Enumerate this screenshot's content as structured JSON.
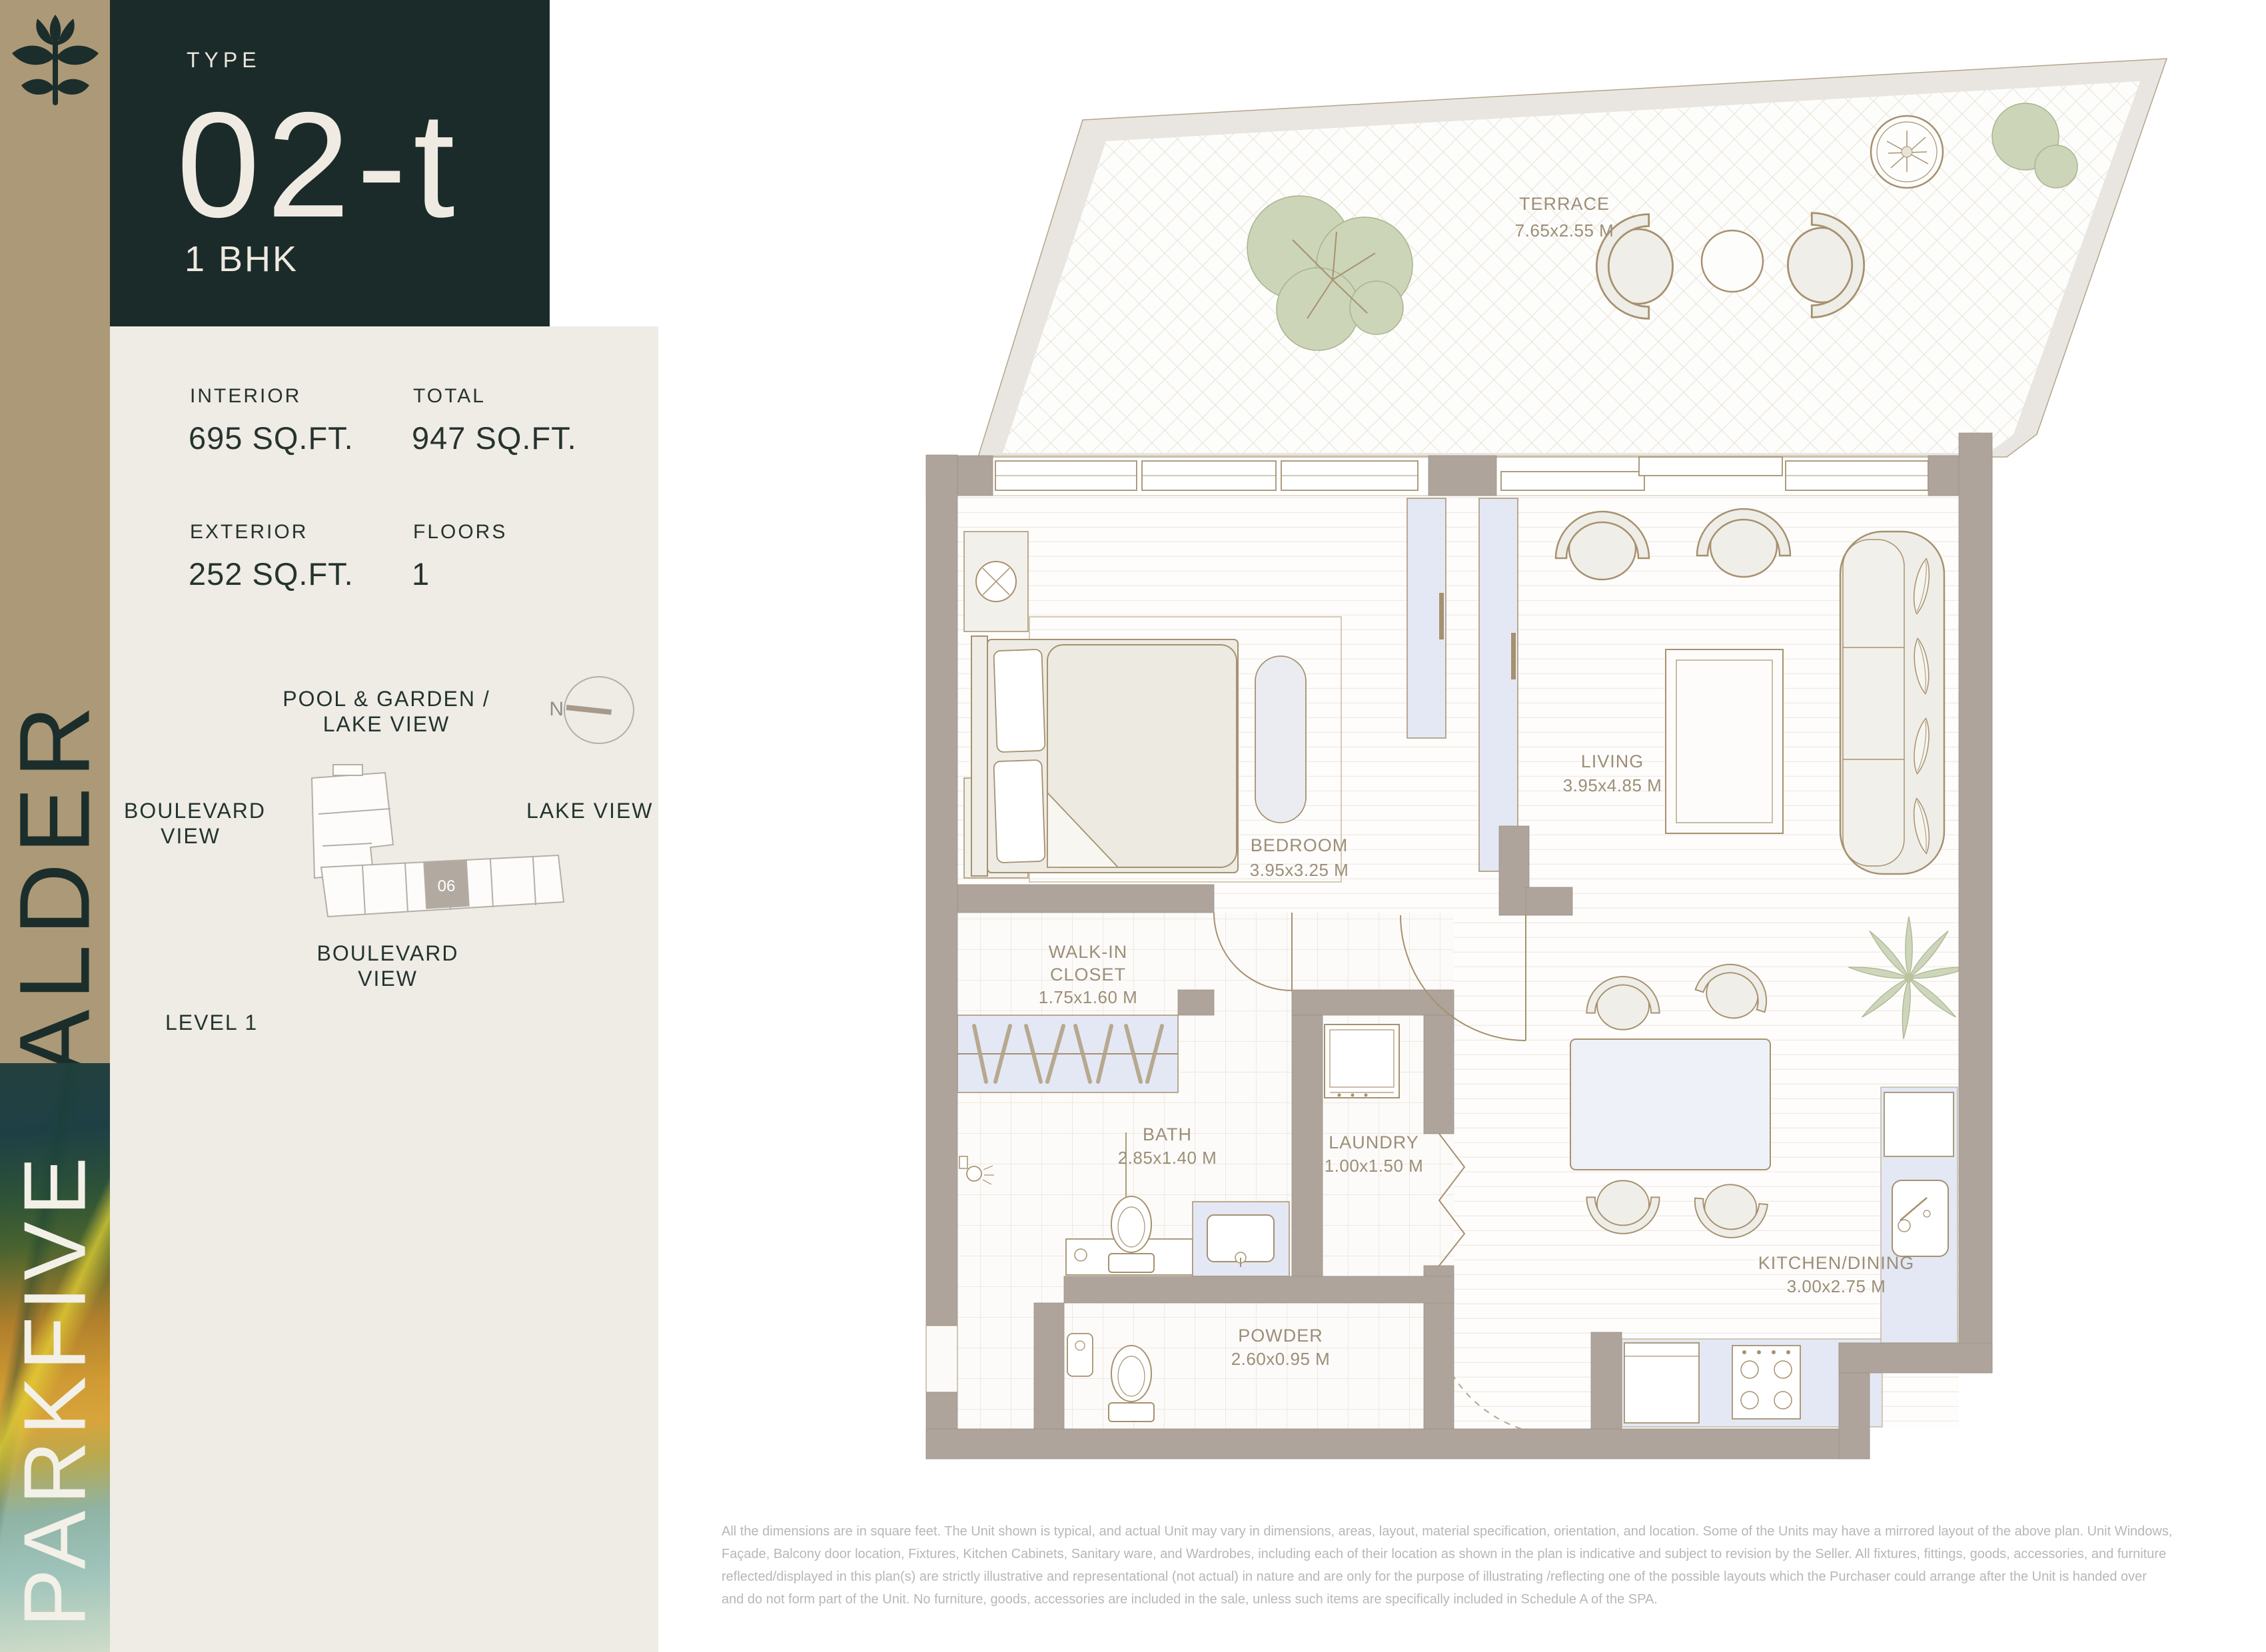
{
  "brand": {
    "building": "ALDER",
    "project": "PARKFIVE"
  },
  "unit": {
    "type_label": "TYPE",
    "type_value": "02-t",
    "config": "1 BHK"
  },
  "stats": {
    "items": [
      {
        "label": "INTERIOR",
        "value": "695 SQ.FT."
      },
      {
        "label": "TOTAL",
        "value": "947 SQ.FT."
      },
      {
        "label": "EXTERIOR",
        "value": "252 SQ.FT."
      },
      {
        "label": "FLOORS",
        "value": "1"
      }
    ]
  },
  "siteplan": {
    "compass": "N",
    "top_label_line1": "POOL & GARDEN /",
    "top_label_line2": "LAKE VIEW",
    "left_label_line1": "BOULEVARD",
    "left_label_line2": "VIEW",
    "right_label": "LAKE VIEW",
    "bottom_label_line1": "BOULEVARD",
    "bottom_label_line2": "VIEW",
    "level": "LEVEL 1",
    "unit_number": "06"
  },
  "floorplan": {
    "rooms": {
      "terrace": {
        "name": "TERRACE",
        "dims": "7.65x2.55 M"
      },
      "bedroom": {
        "name": "BEDROOM",
        "dims": "3.95x3.25 M"
      },
      "living": {
        "name": "LIVING",
        "dims": "3.95x4.85 M"
      },
      "walkin": {
        "name_line1": "WALK-IN",
        "name_line2": "CLOSET",
        "dims": "1.75x1.60 M"
      },
      "bath": {
        "name": "BATH",
        "dims": "2.85x1.40 M"
      },
      "laundry": {
        "name": "LAUNDRY",
        "dims": "1.00x1.50 M"
      },
      "kitchen": {
        "name": "KITCHEN/DINING",
        "dims": "3.00x2.75 M"
      },
      "powder": {
        "name": "POWDER",
        "dims": "2.60x0.95 M"
      }
    }
  },
  "disclaimer": {
    "lines": [
      "All the dimensions are in square feet. The Unit shown is typical, and actual Unit may vary in dimensions, areas, layout, material specification, orientation, and location. Some of the Units may have a mirrored layout of the above plan. Unit Windows,",
      "Façade, Balcony door location, Fixtures, Kitchen Cabinets, Sanitary ware, and Wardrobes, including each of their location as shown in the plan is indicative and subject to revision by the Seller. All fixtures, fittings, goods, accessories, and furniture",
      "reflected/displayed in this plan(s) are strictly illustrative and representational (not actual) in nature and are only for the purpose of illustrating /reflecting one of the possible layouts which the Purchaser could arrange after the Unit is handed over",
      "and do not form part of the Unit. No furniture, goods, accessories are included in the sale, unless such items are specifically included in Schedule A of the SPA."
    ]
  },
  "colors": {
    "brand_dark": "#1B2B29",
    "brand_tan": "#AC9977",
    "panel_cream": "#EFECE5",
    "wall_taupe": "#AEA49B",
    "fixture_blue": "#E3E8F4",
    "plant_sage": "#CCD5B8",
    "line_tan": "#A6916F",
    "room_label": "#9C8E78",
    "disclaimer_gray": "#B7B7B5"
  }
}
